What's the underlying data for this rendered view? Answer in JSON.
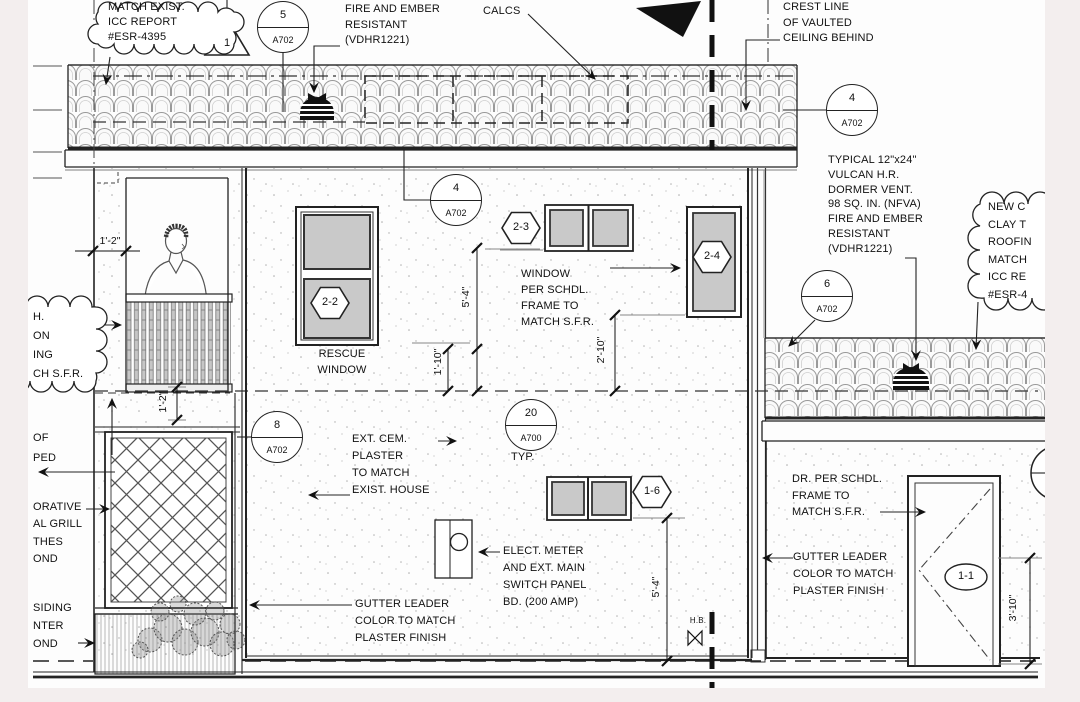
{
  "drawing": {
    "clouds": {
      "icc": "MATCH EXIST.\nICC REPORT\n#ESR-4395",
      "left_partial": "H.\nON\nING\nCH S.F.R.",
      "new_clay": "NEW C\nCLAY T\nROOFIN\nMATCH\nICC RE\n#ESR-4"
    },
    "notes": {
      "fire_ember_top": "FIRE AND EMBER\nRESISTANT\n(VDHR1221)",
      "calcs": "CALCS",
      "crest_line": "CREST LINE\nOF VAULTED\nCEILING BEHIND",
      "dormer_vent": "TYPICAL 12\"x24\"\nVULCAN H.R.\nDORMER VENT.\n98 SQ. IN. (NFVA)\nFIRE AND EMBER\nRESISTANT\n(VDHR1221)",
      "window_schedule": "WINDOW\nPER SCHDL.\nFRAME TO\nMATCH S.F.R.",
      "rescue_window": "RESCUE\nWINDOW",
      "ext_plaster": "EXT. CEM.\nPLASTER\nTO MATCH\nEXIST. HOUSE",
      "elect_meter": "ELECT. METER\nAND EXT. MAIN\nSWITCH PANEL\nBD. (200 AMP)",
      "gutter_left": "GUTTER LEADER\nCOLOR TO MATCH\nPLASTER FINISH",
      "gutter_right": "GUTTER LEADER\nCOLOR TO MATCH\nPLASTER FINISH",
      "door_schedule": "DR. PER SCHDL.\nFRAME TO\nMATCH S.F.R.",
      "of_ped": "OF\nPED",
      "decorative_grill": "ORATIVE\nAL GRILL\nTHES\nOND",
      "siding_planter": "SIDING\nNTER\nOND",
      "typ": "TYP.",
      "hose_bib": "H.B."
    },
    "callouts": [
      {
        "num": "5",
        "sheet": "A702"
      },
      {
        "num": "4",
        "sheet": "A702"
      },
      {
        "num": "4",
        "sheet": "A702"
      },
      {
        "num": "6",
        "sheet": "A702"
      },
      {
        "num": "8",
        "sheet": "A702"
      },
      {
        "num": "20",
        "sheet": "A700"
      }
    ],
    "revision_triangle": "1",
    "tags": {
      "w22": "2-2",
      "w23": "2-3",
      "w24": "2-4",
      "w16": "1-6",
      "door": "1-1"
    },
    "dims": {
      "d12h": "1'-2\"",
      "d12v": "1'-2\"",
      "d54u": "5'-4\"",
      "d110": "1'-10\"",
      "d210": "2'-10\"",
      "d54l": "5'-4\"",
      "d310": "3'-10\""
    },
    "colors": {
      "line": "#1a1a1a",
      "glass": "#c9c9c9",
      "sheet": "#fdfdfd",
      "margin": "#f3eeee"
    }
  }
}
